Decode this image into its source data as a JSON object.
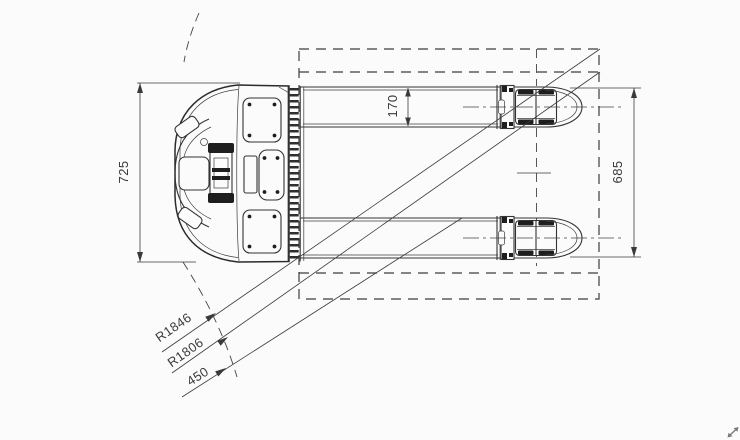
{
  "drawing": {
    "background": "#fbfbfb",
    "line_color": "#333333",
    "labels": {
      "overall_width": "725",
      "fork_width": "170",
      "fork_span": "685",
      "outer_turning_radius": "R1846",
      "inner_turning_radius": "R1806",
      "offset": "450"
    },
    "icons": {
      "resize_arrow": "⤢"
    }
  }
}
